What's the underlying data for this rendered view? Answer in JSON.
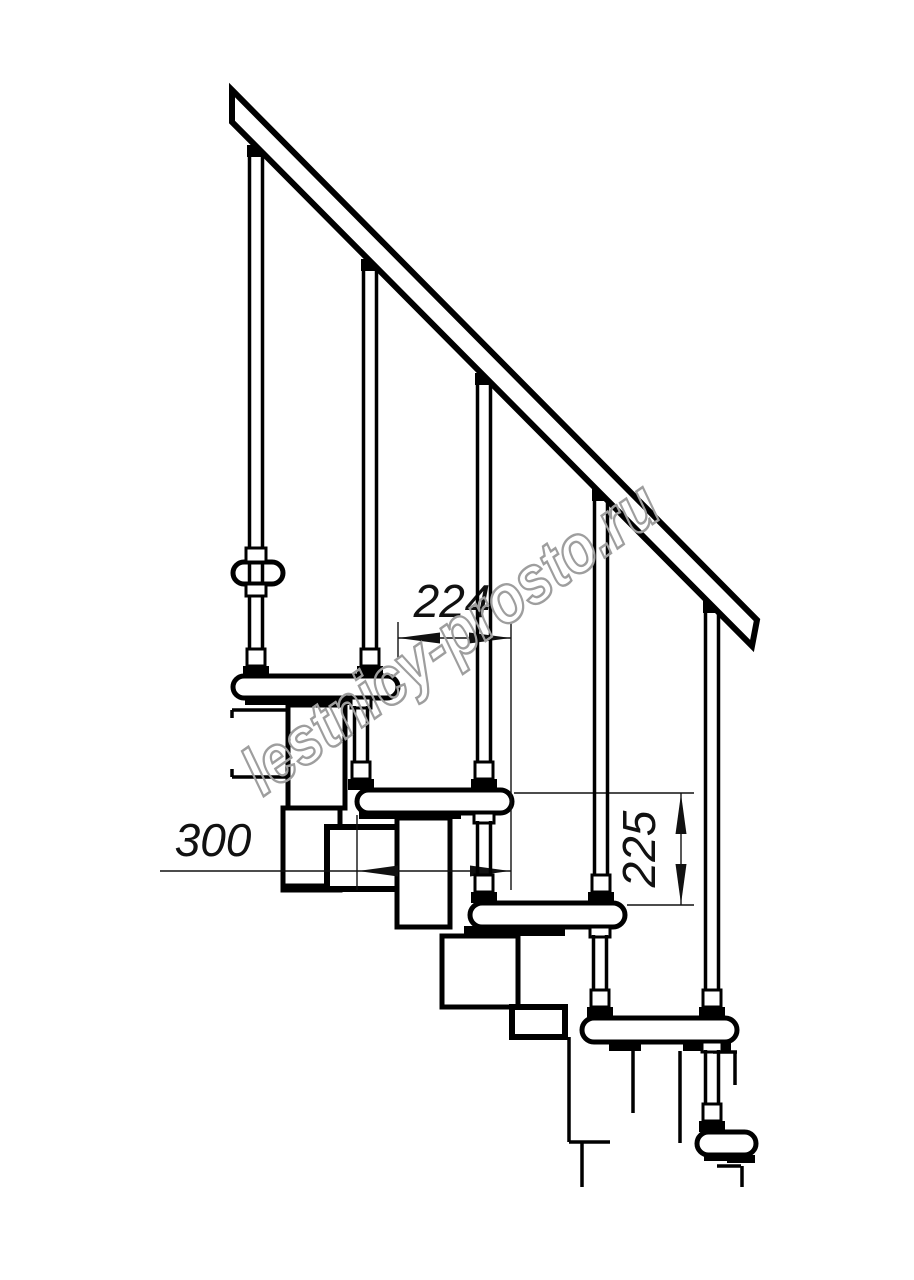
{
  "drawing": {
    "watermark": "lestnicy-prosto.ru",
    "dimensions": {
      "going": "224",
      "tread_depth": "300",
      "rise": "225"
    },
    "colors": {
      "line": "#000000",
      "background": "#ffffff",
      "dimension_line": "#111111",
      "watermark": "#9e9e9e"
    }
  }
}
